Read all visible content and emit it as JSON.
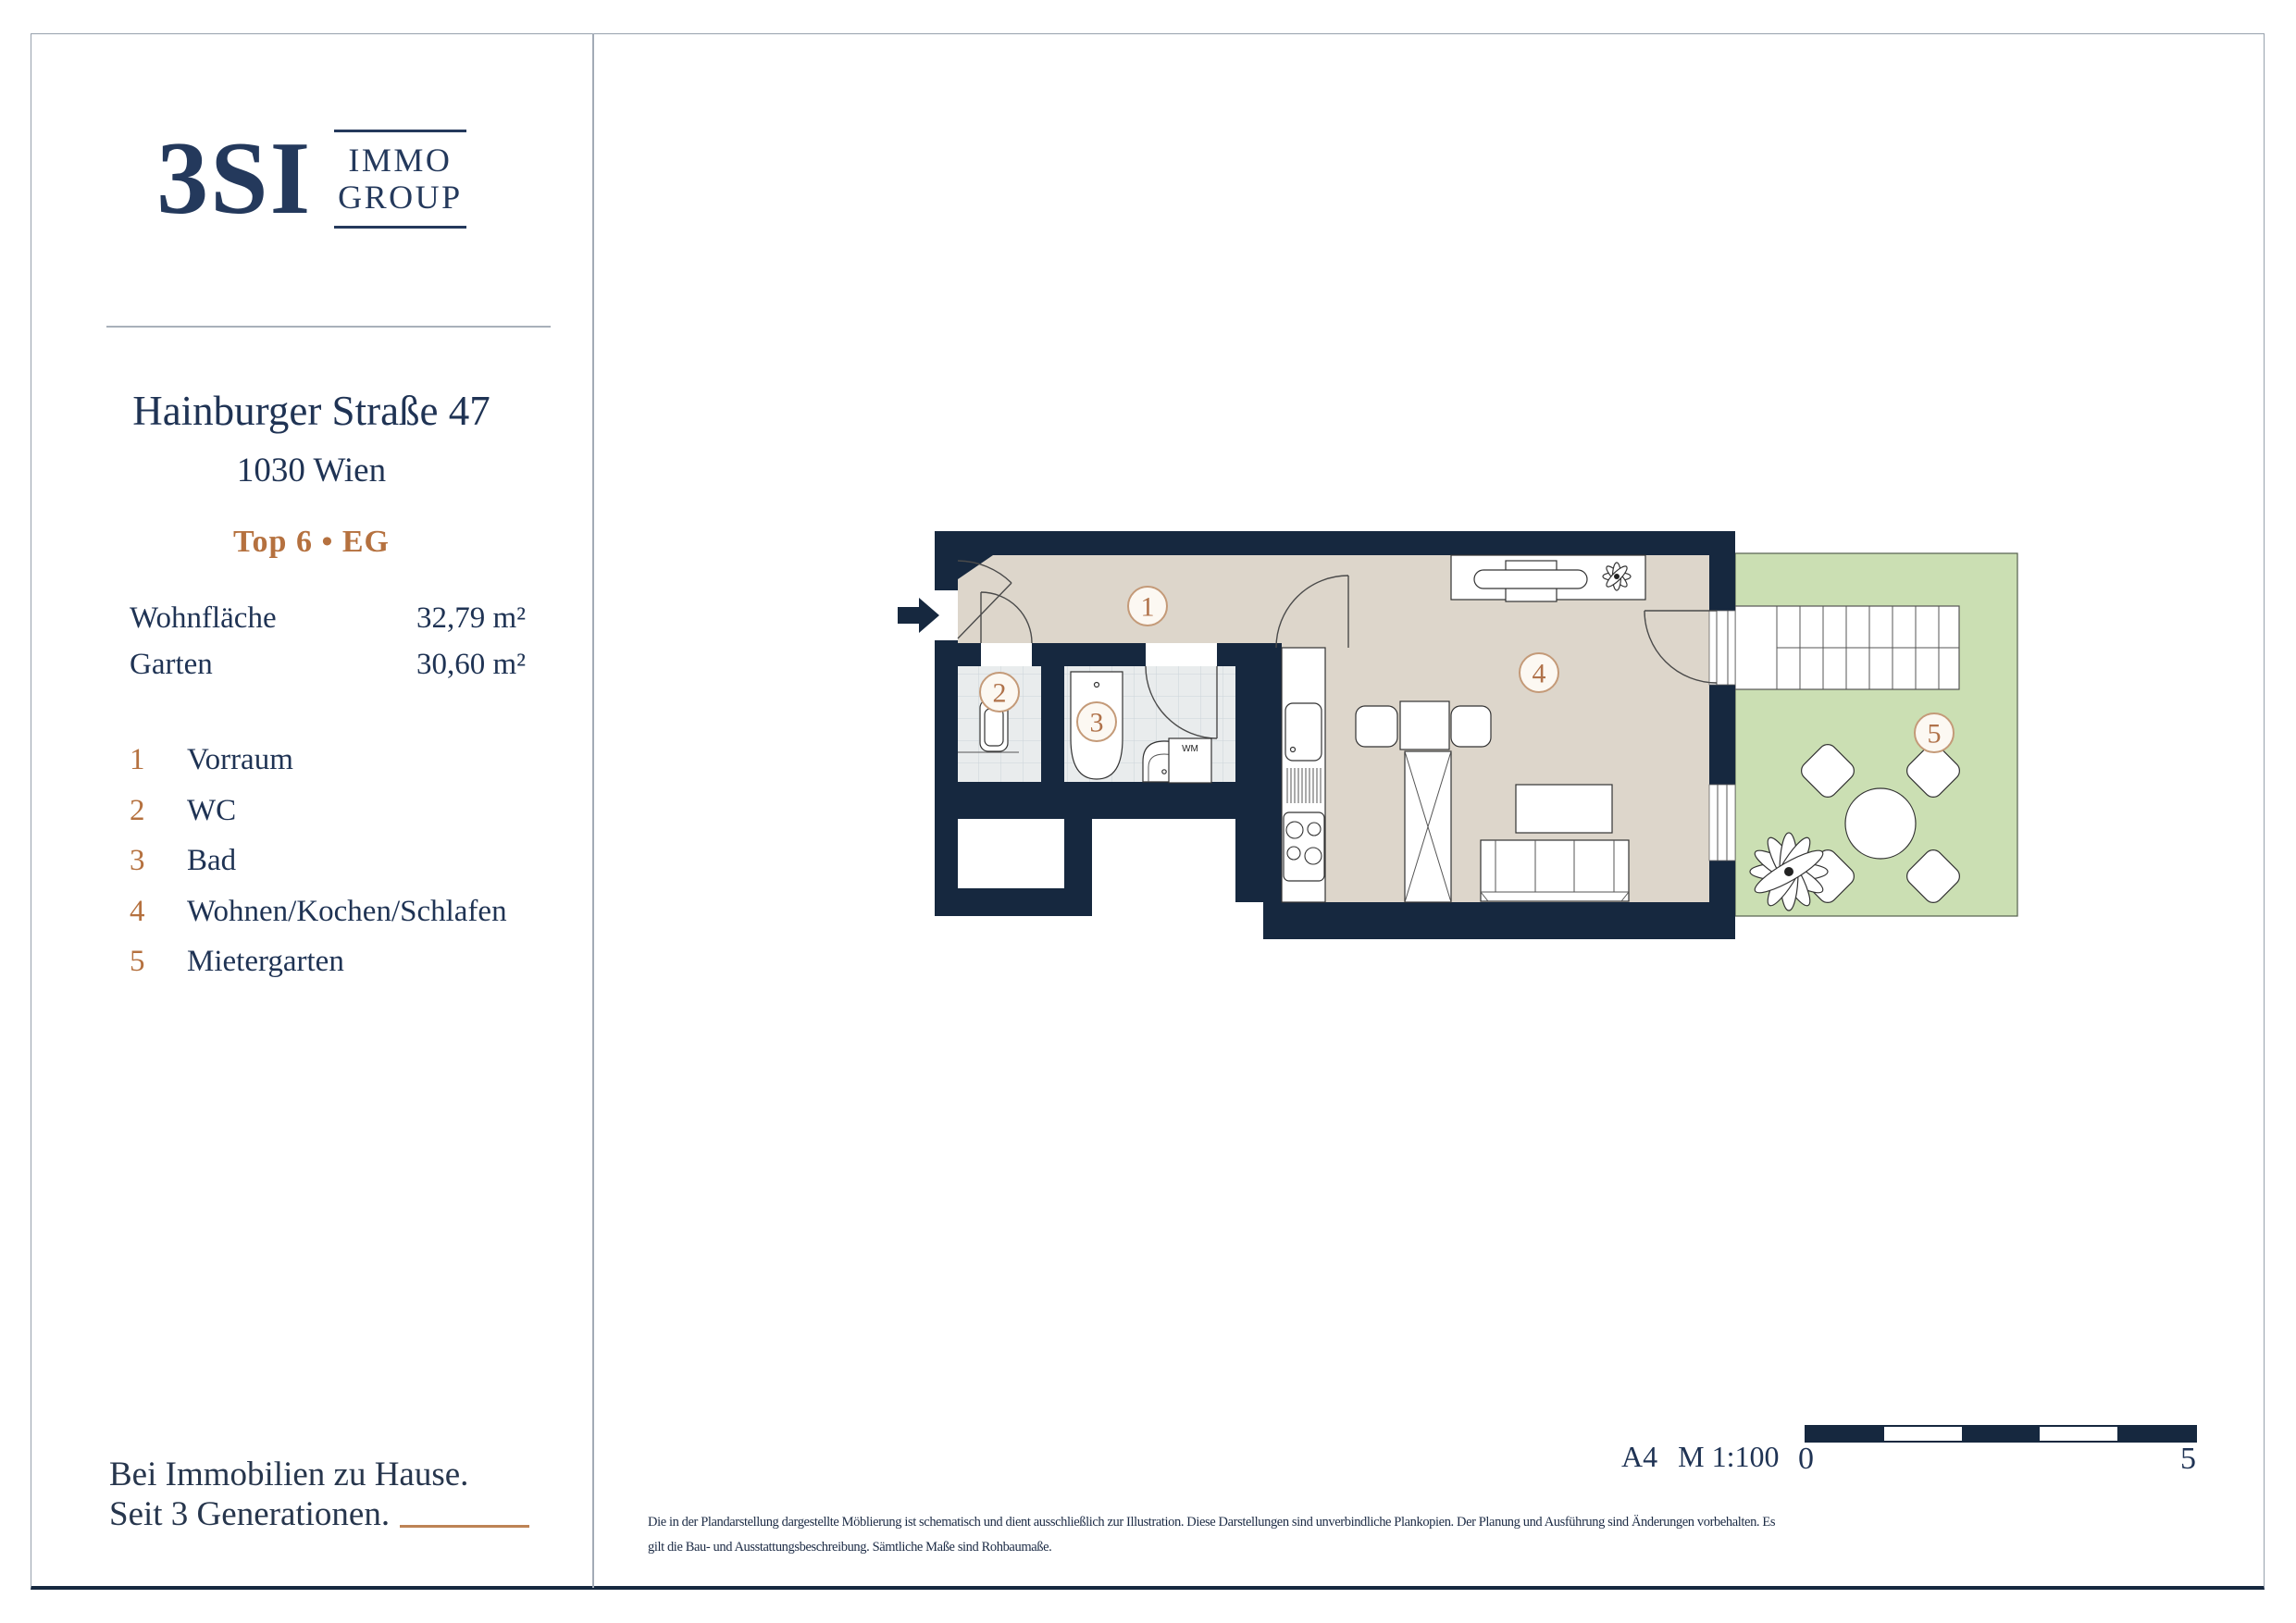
{
  "brand": {
    "logo_main": "3SI",
    "logo_sub_line1": "IMMO",
    "logo_sub_line2": "GROUP"
  },
  "property": {
    "street": "Hainburger Straße 47",
    "city": "1030 Wien",
    "unit_label": "Top 6 • EG"
  },
  "area_table": {
    "rows": [
      {
        "label": "Wohnfläche",
        "value": "32,79 m²"
      },
      {
        "label": "Garten",
        "value": "30,60 m²"
      }
    ]
  },
  "legend": {
    "items": [
      {
        "num": "1",
        "label": "Vorraum"
      },
      {
        "num": "2",
        "label": "WC"
      },
      {
        "num": "3",
        "label": "Bad"
      },
      {
        "num": "4",
        "label": "Wohnen/Kochen/Schlafen"
      },
      {
        "num": "5",
        "label": "Mietergarten"
      }
    ]
  },
  "tagline": {
    "line1": "Bei Immobilien zu Hause.",
    "line2": "Seit 3 Generationen."
  },
  "plan": {
    "badges": [
      "1",
      "2",
      "3",
      "4",
      "5"
    ],
    "wm_label": "WM"
  },
  "footer": {
    "sheet_format": "A4",
    "scale_text": "M 1:100",
    "scale_start": "0",
    "scale_end": "5",
    "disclaimer_line1": "Die in der Plandarstellung dargestellte Möblierung ist schematisch und dient ausschließlich zur Illustration. Diese Darstellungen sind unverbindliche Plankopien. Der Planung und Ausführung sind Änderungen vorbehalten. Es",
    "disclaimer_line2": "gilt die Bau- und Ausstattungsbeschreibung. Sämtliche Maße sind Rohbaumaße."
  },
  "colors": {
    "wall_navy": "#16283f",
    "text_navy": "#1f3354",
    "bronze": "#b5713f",
    "floor_beige": "#ddd6cb",
    "floor_tile": "#e9eced",
    "garden_green": "#cbdfb3",
    "badge_stroke": "#c49a78",
    "badge_fill": "#fcf8f2"
  }
}
